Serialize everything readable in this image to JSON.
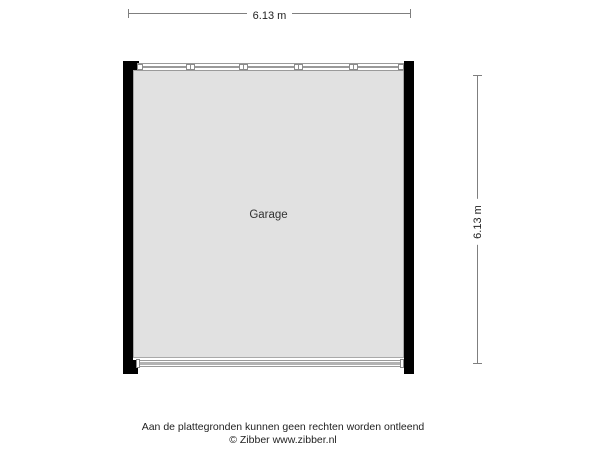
{
  "plan": {
    "room": {
      "label": "Garage"
    },
    "dimension_top": {
      "label": "6.13 m"
    },
    "dimension_right": {
      "label": "6.13 m"
    }
  },
  "footer": {
    "disclaimer": "Aan de plattegronden kunnen geen rechten worden ontleend",
    "copyright": "© Zibber www.zibber.nl"
  },
  "colors": {
    "wall": "#000000",
    "floor": "#e1e1e1",
    "floor-border": "#a9a9a9",
    "feature-line": "#9a9a9a",
    "door-slab": "#b3b3b3",
    "dim-line": "#7f7f7f",
    "text": "#1f1f1f"
  }
}
